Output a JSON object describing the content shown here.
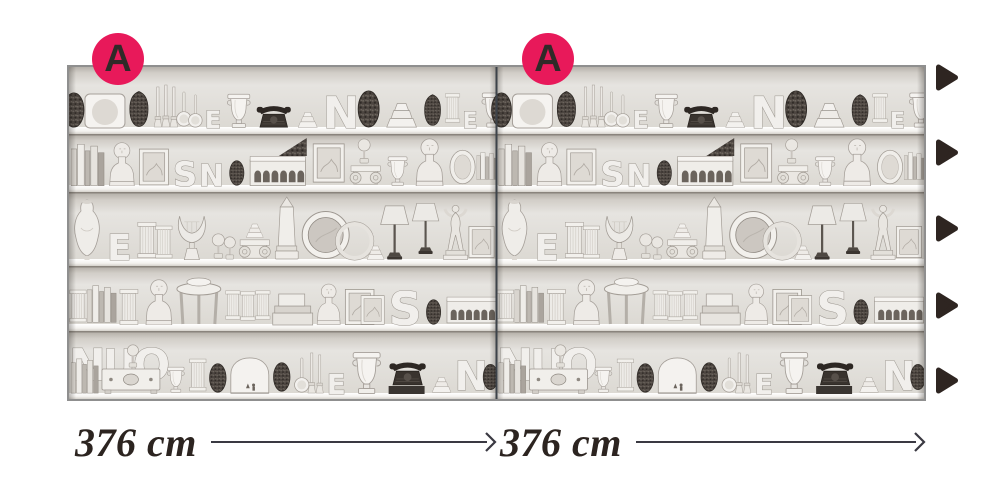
{
  "diagram": {
    "markers": [
      {
        "label": "A"
      },
      {
        "label": "A"
      }
    ],
    "dimensions": [
      {
        "label": "376 cm"
      },
      {
        "label": "376 cm"
      }
    ],
    "repeat_arrows": {
      "count": 5,
      "direction": "right"
    },
    "icons": {
      "panel_marker": "circle-badge",
      "repeat_arrow": "right-triangle-icon",
      "dimension_arrow": "right-arrow-line"
    },
    "colors": {
      "marker_background": "#e8195a",
      "marker_letter": "#2f2a28",
      "ink": "#2c2420",
      "dimension_line": "#3a3942",
      "panel_border": "#8f8f8f",
      "panel_divider": "#3d434a",
      "wallpaper_wall": "#e0ddd8"
    },
    "wallpaper": {
      "panels": 2,
      "shelf_rows": 5,
      "style": "white shelves crowded with urns, vases, busts, block letters, frames and curiosities"
    }
  }
}
